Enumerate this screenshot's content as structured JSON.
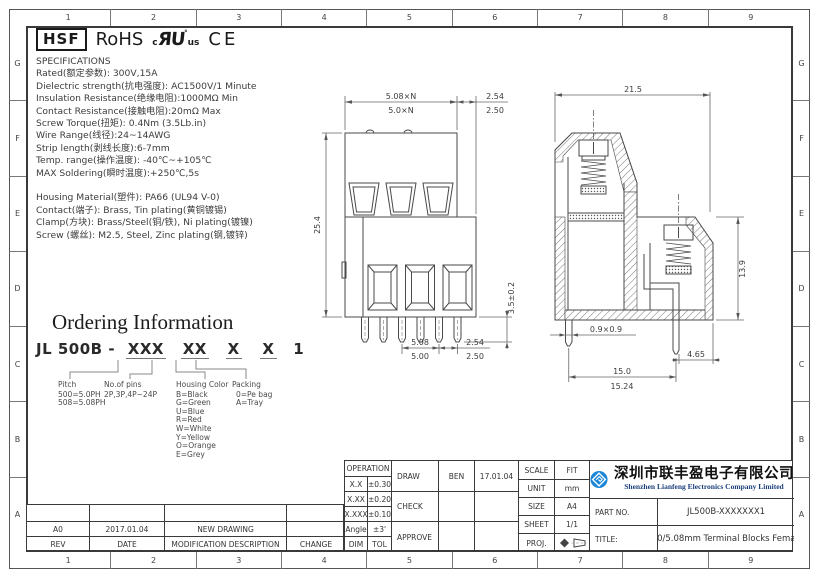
{
  "frame": {
    "cols": [
      "1",
      "2",
      "3",
      "4",
      "5",
      "6",
      "7",
      "8",
      "9"
    ],
    "rows": [
      "G",
      "F",
      "E",
      "D",
      "C",
      "B",
      "A"
    ]
  },
  "certs": {
    "hsf": "HSF",
    "rohs": "RoHS",
    "ul_c": "c",
    "ul_mark": "ЯU",
    "ul_reg": "°",
    "ul_us": "us",
    "ce": "CE"
  },
  "specs": {
    "title": "SPECIFICATIONS",
    "lines": [
      "Rated(额定参数): 300V,15A",
      "Dielectric strength(抗电强度): AC1500V/1 Minute",
      "Insulation Resistance(绝缘电阻):1000MΩ Min",
      "Contact Resistance(接触电阻):20mΩ Max",
      "Screw Torque(扭矩): 0.4Nm (3.5Lb.in)",
      "Wire Range(线径):24~14AWG",
      "Strip length(剥线长度):6-7mm",
      "Temp. range(操作温度): -40℃~+105℃",
      "MAX Soldering(瞬时温度):+250℃,5s"
    ]
  },
  "materials": {
    "lines": [
      "Housing Material(塑件): PA66 (UL94 V-0)",
      "Contact(端子): Brass, Tin plating(黄铜镀锡)",
      "Clamp(方块): Brass/Steel(铜/铁), Ni plating(镀镍)",
      "Screw (螺丝): M2.5, Steel, Zinc plating(钢,镀锌)"
    ]
  },
  "ordering": {
    "title": "Ordering Information",
    "prefix": "JL 500B -",
    "seg1": "XXX",
    "seg2": "XX",
    "seg3": "X",
    "seg4": "X",
    "seg5": "1",
    "legend": [
      {
        "title": "Pitch",
        "lines": [
          "500=5.0PH",
          "508=5.08PH"
        ]
      },
      {
        "title": "No.of pins",
        "lines": [
          "2P,3P,4P~24P"
        ]
      },
      {
        "title": "Housing Color",
        "lines": [
          "B=Black",
          "G=Green",
          "U=Blue",
          "R=Red",
          "W=White",
          "Y=Yellow",
          "O=Orange",
          "E=Grey"
        ]
      },
      {
        "title": "Packing",
        "lines": [
          "0=Pe bag",
          "A=Tray"
        ]
      }
    ]
  },
  "front_view": {
    "dims": {
      "pitch_top": "5.08×N",
      "pitch_top_alt": "5.0×N",
      "end_top": "2.54",
      "end_top_alt": "2.50",
      "height": "25.4",
      "pin_length": "3.5±0.2",
      "pitch_bottom": "5.08",
      "pitch_bottom_alt": "5.00",
      "end_bottom": "2.54",
      "end_bottom_alt": "2.50"
    }
  },
  "side_view": {
    "dims": {
      "width": "21.5",
      "lower_height": "13.9",
      "pin_section": "0.9×0.9",
      "pin_inset": "4.65",
      "span": "15.0",
      "span_alt": "15.24"
    }
  },
  "revision": {
    "headers": {
      "rev": "REV",
      "date": "DATE",
      "desc": "MODIFICATION DESCRIPTION",
      "change": "CHANGE"
    },
    "rows": [
      {
        "rev": "A0",
        "date": "2017.01.04",
        "desc": "NEW DRAWING",
        "change": ""
      }
    ]
  },
  "title_block": {
    "operation": {
      "title": "OPERATION",
      "rows": [
        [
          "X.X",
          "±0.30"
        ],
        [
          "X.XX",
          "±0.20"
        ],
        [
          "X.XXX",
          "±0.10"
        ],
        [
          "Angle",
          "±3'"
        ],
        [
          "DIM",
          "TOL"
        ]
      ]
    },
    "sign": {
      "draw_label": "DRAW",
      "draw_name": "BEN",
      "draw_date": "17.01.04",
      "check_label": "CHECK",
      "approve_label": "APPROVE"
    },
    "info": {
      "scale_label": "SCALE",
      "scale": "FIT",
      "unit_label": "UNIT",
      "unit": "mm",
      "size_label": "SIZE",
      "size": "A4",
      "sheet_label": "SHEET",
      "sheet": "1/1",
      "proj_label": "PROJ."
    },
    "part_label": "PART NO.",
    "part_no": "JL500B-XXXXXXX1",
    "title_label": "TITLE:",
    "title": "5.0/5.08mm Terminal Blocks Female"
  },
  "company": {
    "name_cn": "深圳市联丰盈电子有限公司",
    "name_en": "Shenzhen Lianfeng Electronics Company Limited",
    "logo_color": "#1b86d8"
  }
}
